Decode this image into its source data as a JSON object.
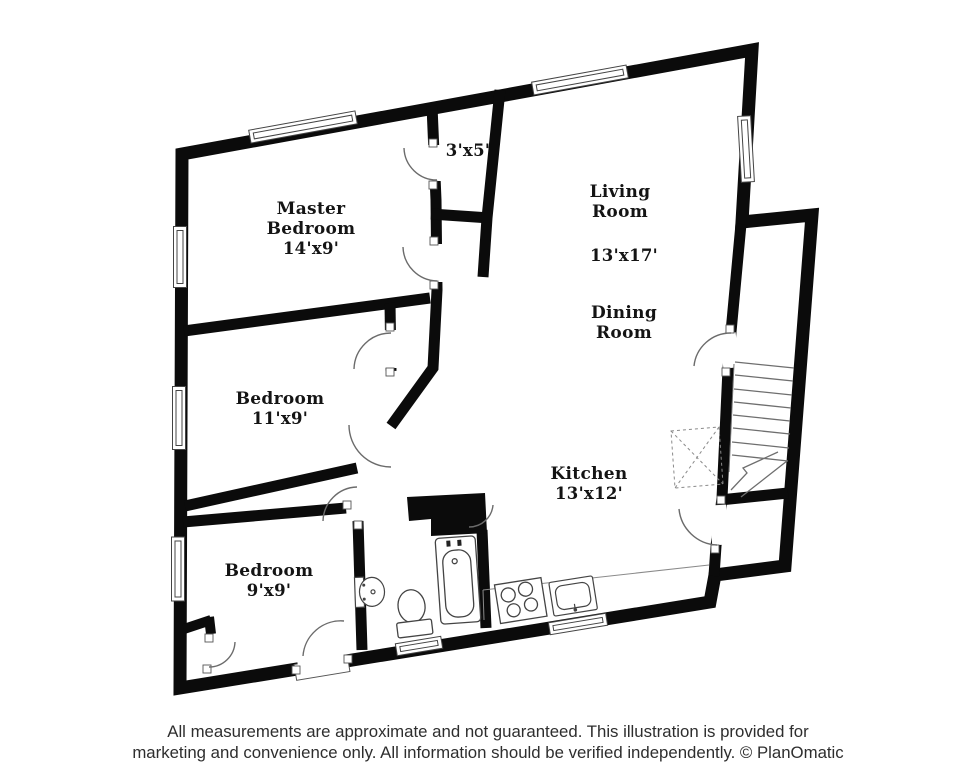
{
  "rooms": {
    "master": {
      "name": "Master Bedroom",
      "dims": "14'x9'"
    },
    "bedroom_mid": {
      "name": "Bedroom",
      "dims": "11'x9'"
    },
    "bedroom_lower": {
      "name": "Bedroom",
      "dims": "9'x9'"
    },
    "living": {
      "name": "Living Room",
      "dims": "13'x17'"
    },
    "dining": {
      "name": "Dining Room"
    },
    "kitchen": {
      "name": "Kitchen",
      "dims": "13'x12'"
    },
    "closet": {
      "dims": "3'x5'"
    }
  },
  "fixtures": [
    "bathtub",
    "toilet",
    "pedestal-sink",
    "stove",
    "kitchen-sink",
    "staircase",
    "dashed-x-box",
    "door-arcs",
    "windows"
  ],
  "colors": {
    "walls": "#0b0b0b",
    "background": "#ffffff",
    "thin_lines": "#555555"
  },
  "footer": {
    "line1": "All measurements are approximate and not guaranteed. This illustration is provided for",
    "line2": "marketing and convenience only. All information should be verified independently. © PlanOmatic"
  }
}
